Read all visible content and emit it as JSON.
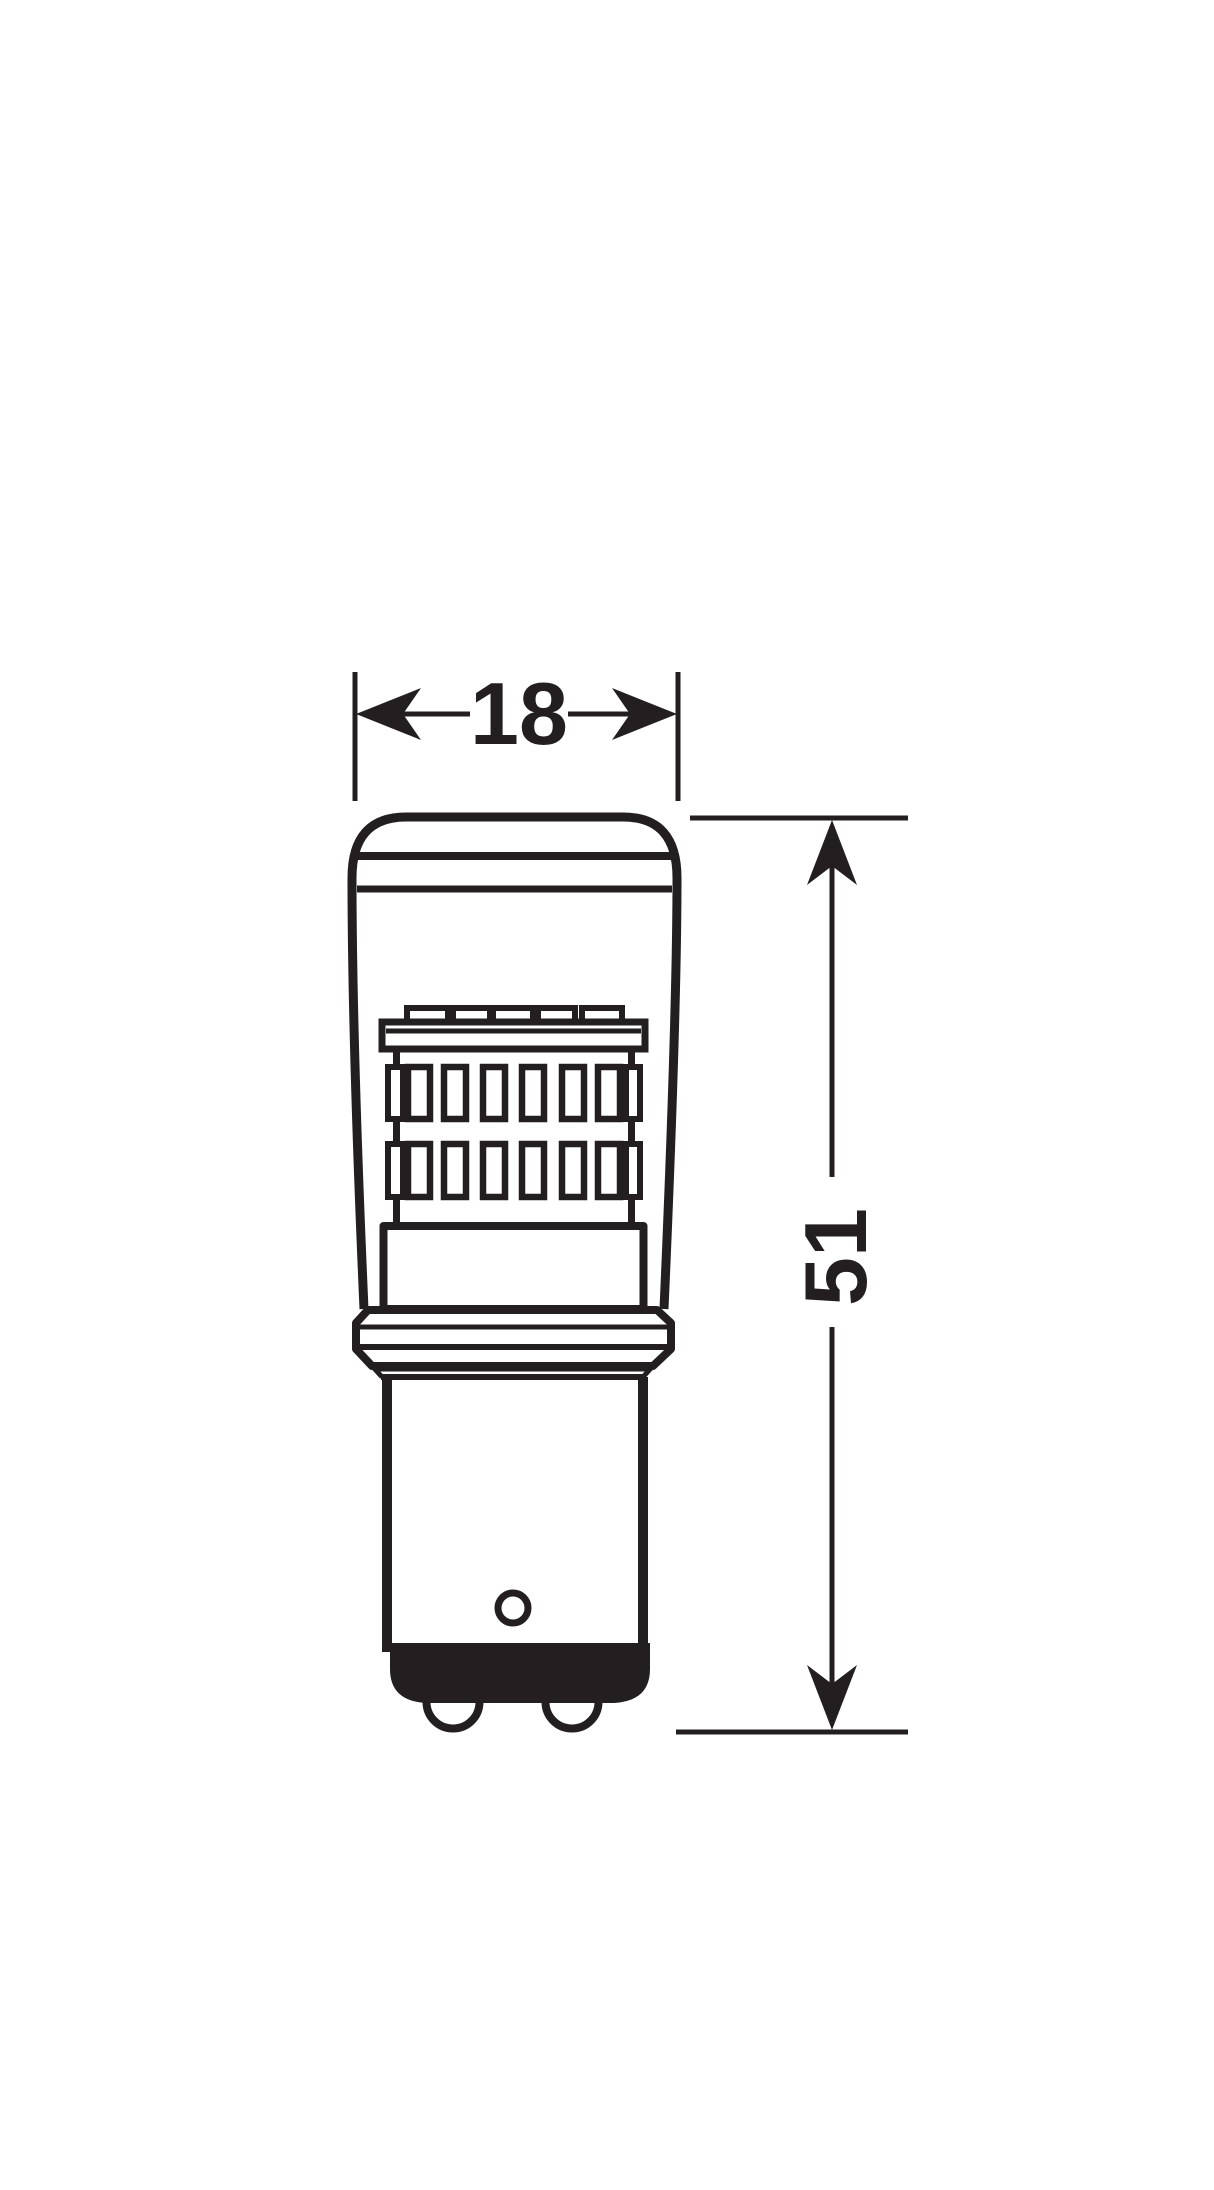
{
  "diagram": {
    "type": "technical-dimension-drawing",
    "subject": "LED retrofit bulb with bayonet base, side elevation",
    "background_color": "#ffffff",
    "ink_color": "#231f20",
    "width_dimension": {
      "value": "18"
    },
    "height_dimension": {
      "value": "51"
    },
    "structure": {
      "top_chip_count": 5,
      "led_rows": 2,
      "led_columns": 6,
      "bottom_contact_count": 2
    }
  }
}
